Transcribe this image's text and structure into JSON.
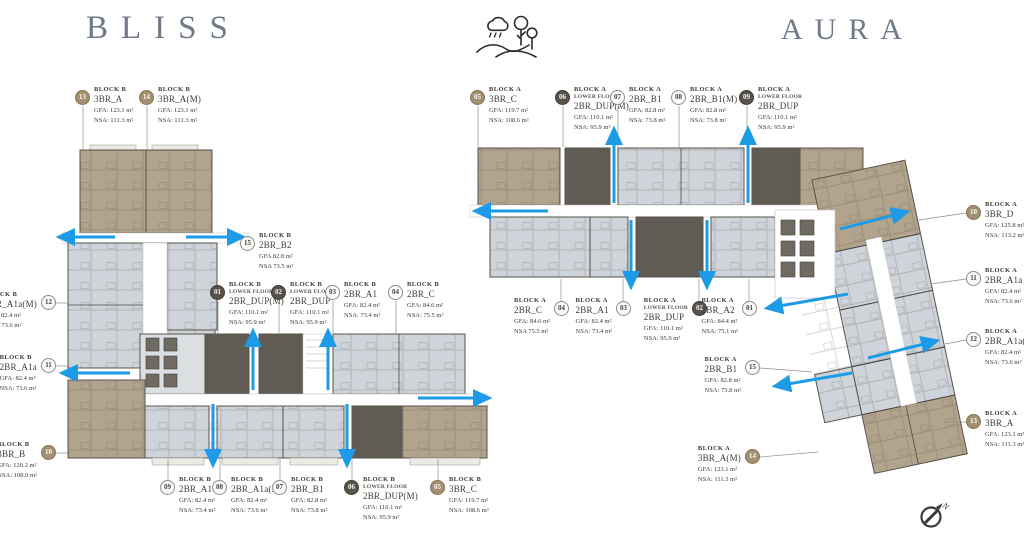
{
  "titles": {
    "left": "BLISS",
    "right": "AURA"
  },
  "compass": {
    "label": "N"
  },
  "colors": {
    "tan": "#b2a38d",
    "light": "#ced4d9",
    "dark": "#605c55",
    "arrow": "#1e9be7",
    "title": "#6f7987",
    "leader": "#918d86"
  },
  "icons": [
    "landscape-icon",
    "compass-north-icon"
  ],
  "labels": [
    {
      "num": "13",
      "style": "tan",
      "block": "BLOCK B",
      "floor": "",
      "unit": "3BR_A",
      "gfa": "GFA: 123.1 m²",
      "nsa": "NSA: 111.3 m²",
      "cx": 83,
      "cy": 98,
      "side": "right",
      "leader": [
        83,
        106,
        83,
        149
      ]
    },
    {
      "num": "14",
      "style": "tan",
      "block": "BLOCK B",
      "floor": "",
      "unit": "3BR_A(M)",
      "gfa": "GFA: 123.1 m²",
      "nsa": "NSA: 111.3 m²",
      "cx": 147,
      "cy": 98,
      "side": "right",
      "leader": [
        147,
        106,
        147,
        149
      ]
    },
    {
      "num": "15",
      "style": "light",
      "block": "BLOCK B",
      "floor": "",
      "unit": "2BR_B2",
      "gfa": "GFA 82.8 m²",
      "nsa": "NSA 73.5 m²",
      "cx": 248,
      "cy": 244,
      "side": "right",
      "leader": null
    },
    {
      "num": "01",
      "style": "dark",
      "block": "BLOCK B",
      "floor": "LOWER FLOOR",
      "unit": "2BR_DUP(M)",
      "gfa": "GFA: 110.1 m²",
      "nsa": "NSA: 95.9 m²",
      "cx": 218,
      "cy": 293,
      "side": "right",
      "leader": [
        218,
        301,
        218,
        333
      ]
    },
    {
      "num": "02",
      "style": "dark",
      "block": "BLOCK B",
      "floor": "LOWER FLOOR",
      "unit": "2BR_DUP",
      "gfa": "GFA: 110.1 m²",
      "nsa": "NSA: 95.9 m²",
      "cx": 279,
      "cy": 293,
      "side": "right",
      "leader": [
        279,
        301,
        279,
        333
      ]
    },
    {
      "num": "03",
      "style": "light",
      "block": "BLOCK B",
      "floor": "",
      "unit": "2BR_A1",
      "gfa": "GFA: 82.4 m²",
      "nsa": "NSA: 73.4 m²",
      "cx": 333,
      "cy": 293,
      "side": "right",
      "leader": [
        333,
        301,
        333,
        333
      ]
    },
    {
      "num": "04",
      "style": "light",
      "block": "BLOCK B",
      "floor": "",
      "unit": "2BR_C",
      "gfa": "GFA: 84.6 m²",
      "nsa": "NSA: 75.5 m²",
      "cx": 396,
      "cy": 293,
      "side": "right",
      "leader": [
        396,
        301,
        396,
        333
      ]
    },
    {
      "num": "12",
      "style": "light",
      "block": "BLOCK B",
      "floor": "",
      "unit": "2BR_A1a(M)",
      "gfa": "GFA: 82.4 m²",
      "nsa": "NSA: 73.6 m²",
      "cx": 48,
      "cy": 303,
      "side": "left",
      "leader": [
        56,
        303,
        68,
        303
      ]
    },
    {
      "num": "11",
      "style": "light",
      "block": "BLOCK B",
      "floor": "",
      "unit": "2BR_A1a",
      "gfa": "GFA: 82.4 m²",
      "nsa": "NSA: 73.6 m²",
      "cx": 48,
      "cy": 366,
      "side": "left",
      "leader": [
        56,
        366,
        68,
        366
      ]
    },
    {
      "num": "10",
      "style": "tan",
      "block": "BLOCK B",
      "floor": "",
      "unit": "3BR_B",
      "gfa": "GFA: 120.2 m²",
      "nsa": "NSA: 108.0 m²",
      "cx": 48,
      "cy": 453,
      "side": "left",
      "leader": [
        56,
        453,
        68,
        453
      ]
    },
    {
      "num": "09",
      "style": "light",
      "block": "BLOCK B",
      "floor": "",
      "unit": "2BR_A1",
      "gfa": "GFA: 82.4 m²",
      "nsa": "NSA: 73.4 m²",
      "cx": 168,
      "cy": 488,
      "side": "right",
      "leader": [
        168,
        480,
        168,
        459
      ]
    },
    {
      "num": "08",
      "style": "light",
      "block": "BLOCK B",
      "floor": "",
      "unit": "2BR_A1a(M)",
      "gfa": "GFA: 82.4 m²",
      "nsa": "NSA: 73.6 m²",
      "cx": 220,
      "cy": 488,
      "side": "right",
      "leader": [
        220,
        480,
        220,
        459
      ]
    },
    {
      "num": "07",
      "style": "light",
      "block": "BLOCK B",
      "floor": "",
      "unit": "2BR_B1",
      "gfa": "GFA: 82.8 m²",
      "nsa": "NSA: 73.8 m²",
      "cx": 280,
      "cy": 488,
      "side": "right",
      "leader": [
        280,
        480,
        280,
        459
      ]
    },
    {
      "num": "06",
      "style": "dark",
      "block": "BLOCK B",
      "floor": "LOWER FLOOR",
      "unit": "2BR_DUP(M)",
      "gfa": "GFA: 110.1 m²",
      "nsa": "NSA: 95.9 m²",
      "cx": 352,
      "cy": 488,
      "side": "right",
      "leader": [
        352,
        480,
        352,
        459
      ]
    },
    {
      "num": "05",
      "style": "tan",
      "block": "BLOCK B",
      "floor": "",
      "unit": "3BR_C",
      "gfa": "GFA: 119.7 m²",
      "nsa": "NSA: 108.6 m²",
      "cx": 438,
      "cy": 488,
      "side": "right",
      "leader": [
        438,
        480,
        438,
        459
      ]
    },
    {
      "num": "05",
      "style": "tan",
      "block": "BLOCK A",
      "floor": "",
      "unit": "3BR_C",
      "gfa": "GFA: 119.7 m²",
      "nsa": "NSA: 108.6 m²",
      "cx": 478,
      "cy": 98,
      "side": "right",
      "leader": [
        478,
        106,
        478,
        147
      ]
    },
    {
      "num": "06",
      "style": "dark",
      "block": "BLOCK A",
      "floor": "LOWER FLOOR",
      "unit": "2BR_DUP(M)",
      "gfa": "GFA: 110.1 m²",
      "nsa": "NSA: 95.9 m²",
      "cx": 563,
      "cy": 98,
      "side": "right",
      "leader": [
        563,
        106,
        563,
        147
      ]
    },
    {
      "num": "07",
      "style": "light",
      "block": "BLOCK A",
      "floor": "",
      "unit": "2BR_B1",
      "gfa": "GFA: 82.8 m²",
      "nsa": "NSA: 73.8 m²",
      "cx": 618,
      "cy": 98,
      "side": "right",
      "leader": [
        618,
        106,
        618,
        147
      ]
    },
    {
      "num": "08",
      "style": "light",
      "block": "BLOCK A",
      "floor": "",
      "unit": "2BR_B1(M)",
      "gfa": "GFA: 82.8 m²",
      "nsa": "NSA: 73.8 m²",
      "cx": 679,
      "cy": 98,
      "side": "right",
      "leader": [
        679,
        106,
        679,
        147
      ]
    },
    {
      "num": "09",
      "style": "dark",
      "block": "BLOCK A",
      "floor": "LOWER FLOOR",
      "unit": "2BR_DUP",
      "gfa": "GFA: 110.1 m²",
      "nsa": "NSA: 95.9 m²",
      "cx": 747,
      "cy": 98,
      "side": "right",
      "leader": [
        747,
        106,
        747,
        147
      ]
    },
    {
      "num": "10",
      "style": "tan",
      "block": "BLOCK A",
      "floor": "",
      "unit": "3BR_D",
      "gfa": "GFA: 125.8 m²",
      "nsa": "NSA: 113.2 m²",
      "cx": 974,
      "cy": 213,
      "side": "right",
      "leader": [
        966,
        213,
        919,
        220
      ]
    },
    {
      "num": "11",
      "style": "light",
      "block": "BLOCK A",
      "floor": "",
      "unit": "2BR_A1a",
      "gfa": "GFA: 82.4 m²",
      "nsa": "NSA: 73.6 m²",
      "cx": 974,
      "cy": 279,
      "side": "right",
      "leader": [
        966,
        279,
        931,
        284
      ]
    },
    {
      "num": "12",
      "style": "light",
      "block": "BLOCK A",
      "floor": "",
      "unit": "2BR_A1a(M)",
      "gfa": "GFA: 82.4 m²",
      "nsa": "NSA: 73.6 m²",
      "cx": 974,
      "cy": 340,
      "side": "right",
      "leader": [
        966,
        340,
        945,
        344
      ]
    },
    {
      "num": "13",
      "style": "tan",
      "block": "BLOCK A",
      "floor": "",
      "unit": "3BR_A",
      "gfa": "GFA: 123.1 m²",
      "nsa": "NSA: 111.3 m²",
      "cx": 974,
      "cy": 422,
      "side": "right",
      "leader": [
        966,
        422,
        944,
        422
      ]
    },
    {
      "num": "04",
      "style": "light",
      "block": "BLOCK A",
      "floor": "",
      "unit": "2BR_C",
      "gfa": "GFA: 84.6 m²",
      "nsa": "NSA 75.5 m²",
      "cx": 561,
      "cy": 309,
      "side": "left",
      "leader": [
        561,
        301,
        561,
        279
      ]
    },
    {
      "num": "03",
      "style": "light",
      "block": "BLOCK A",
      "floor": "",
      "unit": "2BR_A1",
      "gfa": "GFA: 82.4 m²",
      "nsa": "NSA: 73.4 m²",
      "cx": 623,
      "cy": 309,
      "side": "left",
      "leader": [
        623,
        301,
        623,
        279
      ]
    },
    {
      "num": "02",
      "style": "dark",
      "block": "BLOCK A",
      "floor": "LOWER FLOOR",
      "unit": "2BR_DUP",
      "gfa": "GFA: 110.1 m²",
      "nsa": "NSA: 95.9 m²",
      "cx": 699,
      "cy": 309,
      "side": "left",
      "leader": [
        699,
        301,
        699,
        279
      ]
    },
    {
      "num": "01",
      "style": "light",
      "block": "BLOCK A",
      "floor": "",
      "unit": "2BR_A2",
      "gfa": "GFA: 84.4 m²",
      "nsa": "NSA: 75.1 m²",
      "cx": 749,
      "cy": 309,
      "side": "left",
      "leader": [
        749,
        301,
        749,
        279
      ]
    },
    {
      "num": "15",
      "style": "light",
      "block": "BLOCK A",
      "floor": "",
      "unit": "2BR_B1",
      "gfa": "GFA: 82.8 m²",
      "nsa": "NSA: 73.8 m²",
      "cx": 752,
      "cy": 368,
      "side": "left",
      "leader": [
        760,
        368,
        812,
        372
      ]
    },
    {
      "num": "14",
      "style": "tan",
      "block": "BLOCK A",
      "floor": "",
      "unit": "3BR_A(M)",
      "gfa": "GFA: 123.1 m²",
      "nsa": "NSA: 111.3 m²",
      "cx": 752,
      "cy": 457,
      "side": "left",
      "leader": [
        760,
        457,
        818,
        452
      ]
    }
  ],
  "arrows": [
    [
      115,
      237,
      60,
      237
    ],
    [
      186,
      237,
      242,
      237
    ],
    [
      130,
      373,
      63,
      373
    ],
    [
      253,
      390,
      253,
      332
    ],
    [
      328,
      390,
      328,
      332
    ],
    [
      213,
      404,
      213,
      464
    ],
    [
      347,
      404,
      347,
      464
    ],
    [
      418,
      398,
      488,
      398
    ],
    [
      614,
      203,
      614,
      130
    ],
    [
      748,
      203,
      748,
      130
    ],
    [
      548,
      211,
      476,
      211
    ],
    [
      631,
      220,
      631,
      286
    ],
    [
      707,
      220,
      707,
      286
    ],
    [
      840,
      229,
      906,
      212
    ],
    [
      848,
      294,
      768,
      308
    ],
    [
      868,
      358,
      936,
      341
    ],
    [
      852,
      373,
      776,
      386
    ]
  ]
}
